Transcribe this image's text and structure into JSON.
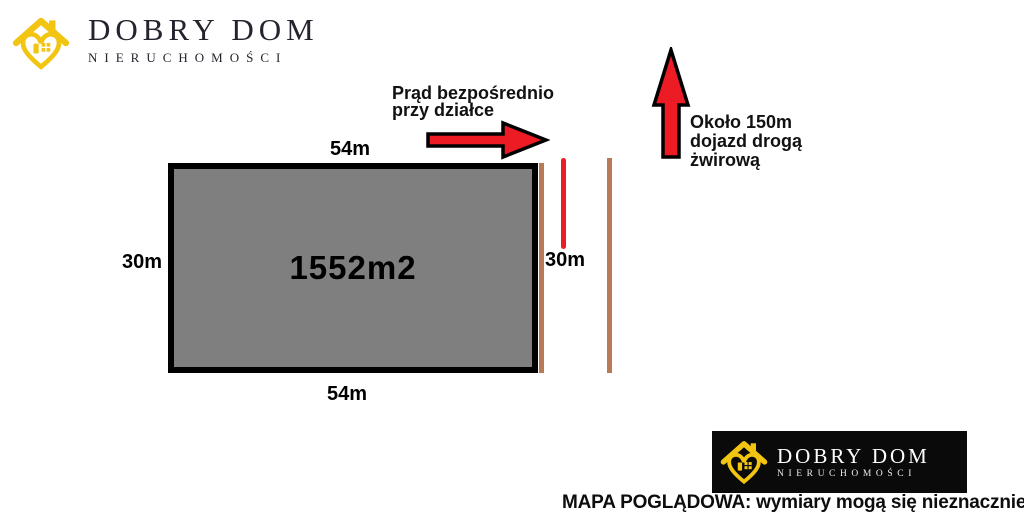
{
  "page": {
    "background": "#ffffff",
    "disclaimer": "MAPA POGLĄDOWA: wymiary mogą się nieznacznie różnić"
  },
  "brand": {
    "top": {
      "title": "DOBRY DOM",
      "subtitle": "NIERUCHOMOŚCI"
    },
    "bottom": {
      "title": "DOBRY DOM",
      "subtitle": "NIERUCHOMOŚCI"
    },
    "colors": {
      "logo_yellow": "#f2c512",
      "logo_dark_text": "#23242e",
      "bottom_box_bg": "#0a0a0a",
      "bottom_box_text": "#ffffff"
    }
  },
  "plot": {
    "area": "1552m2",
    "top_width": "54m",
    "bottom_width": "54m",
    "left_height": "30m",
    "right_height": "30m",
    "fill_color": "#7f7f7f",
    "border_color": "#000000"
  },
  "annotations": {
    "electricity": {
      "line1": "Prąd bezpośrednio",
      "line2": "przy działce"
    },
    "access": {
      "line1": "Około 150m",
      "line2": "dojazd drogą",
      "line3": "żwirową"
    }
  },
  "markers": {
    "arrow_red": "#ed1c24",
    "road_brown": "#b97a57",
    "electric_line_color": "#ed1c24"
  },
  "icons": {
    "brand_icon": "house-heart-icon",
    "electricity_arrow": "right-arrow-icon",
    "access_arrow": "up-arrow-icon"
  }
}
